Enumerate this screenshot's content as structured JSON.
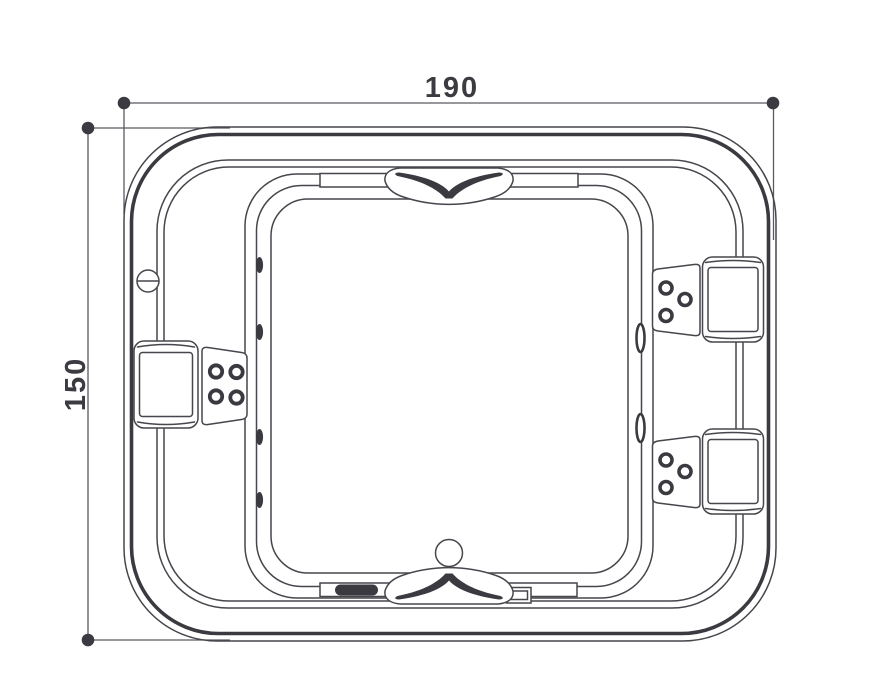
{
  "diagram": {
    "title": "spa-bathtub-top-view-dimension-drawing",
    "dimensions": {
      "width": "190",
      "height": "150"
    },
    "colors": {
      "background": "#ffffff",
      "line": "#46464c",
      "line_heavy": "#3a3a40",
      "dim": "#5a5a60",
      "text": "#3b3b41"
    },
    "features": {
      "square_headrests": 3,
      "chevron_headrests": 2,
      "jet_panels": 3,
      "panel_jets": 10,
      "side_wall_jets_left": 4,
      "side_wall_jets_right": 2,
      "control_knobs": 1,
      "drains": 1
    }
  }
}
